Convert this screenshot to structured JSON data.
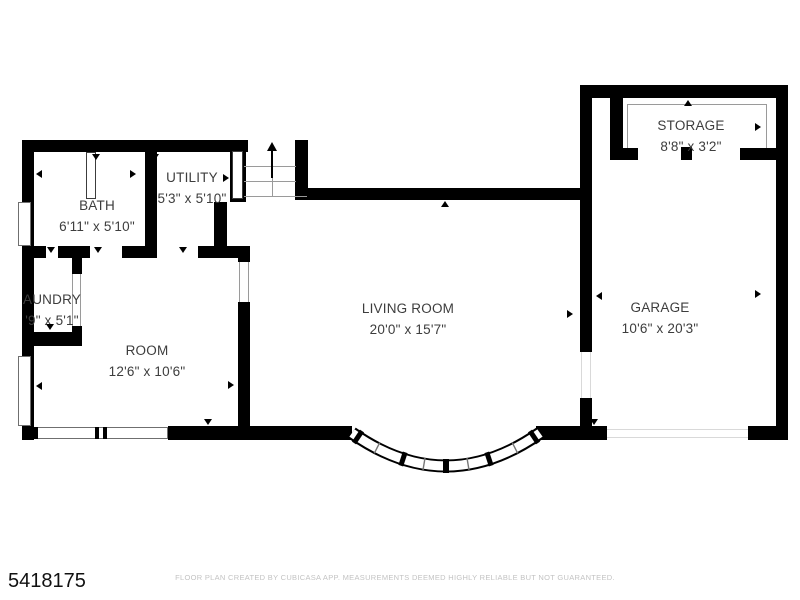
{
  "plan": {
    "listing_id": "5418175",
    "disclaimer": "FLOOR PLAN CREATED BY CUBICASA APP. MEASUREMENTS DEEMED HIGHLY RELIABLE BUT NOT GUARANTEED.",
    "rooms": {
      "bath": {
        "name": "BATH",
        "dims": "6'11\" x 5'10\""
      },
      "utility": {
        "name": "UTILITY",
        "dims": "5'3\" x 5'10\""
      },
      "laundry": {
        "name": "AUNDRY",
        "dims": "'9\" x 5'1\""
      },
      "room": {
        "name": "ROOM",
        "dims": "12'6\" x 10'6\""
      },
      "living_room": {
        "name": "LIVING ROOM",
        "dims": "20'0\" x 15'7\""
      },
      "garage": {
        "name": "GARAGE",
        "dims": "10'6\" x 20'3\""
      },
      "storage": {
        "name": "STORAGE",
        "dims": "8'8\" x 3'2\""
      }
    },
    "colors": {
      "wall": "#000000",
      "label_text": "#3d3d3d",
      "thin_line": "#9a9a9a",
      "disclaimer_text": "#c3c3c3",
      "background": "#ffffff"
    }
  }
}
